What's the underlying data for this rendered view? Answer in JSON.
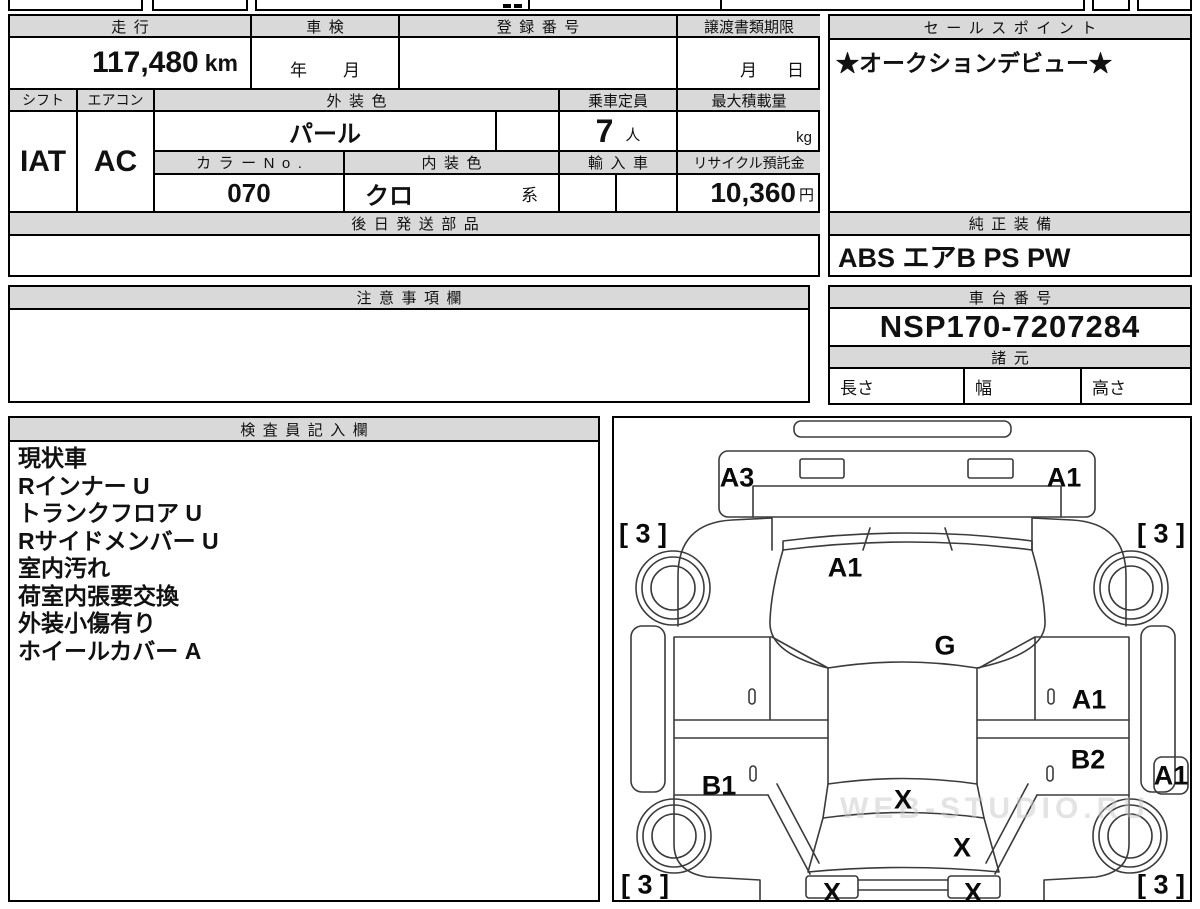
{
  "colors": {
    "header_bg": "#d9d9d9",
    "border": "#000000",
    "text": "#111111",
    "watermark_gray": "#c9c9c9"
  },
  "main_table": {
    "mileage": {
      "label": "走行",
      "value": "117,480",
      "unit": "km"
    },
    "inspection": {
      "label": "車検",
      "year": "年",
      "month": "月"
    },
    "registration": {
      "label": "登録番号",
      "value": ""
    },
    "transfer_docs": {
      "label": "譲渡書類期限",
      "month": "月",
      "day": "日"
    },
    "shift": {
      "label": "シフト",
      "value": "IAT"
    },
    "aircon": {
      "label": "エアコン",
      "value": "AC"
    },
    "exterior_color": {
      "label": "外装色",
      "value": "パール"
    },
    "capacity": {
      "label": "乗車定員",
      "value": "7",
      "unit": "人"
    },
    "max_load": {
      "label": "最大積載量",
      "value": "",
      "unit": "kg"
    },
    "color_no": {
      "label": "カラーNo.",
      "value": "070"
    },
    "interior_color": {
      "label": "内装色",
      "value": "クロ",
      "suffix": "系"
    },
    "import_car": {
      "label": "輸入車",
      "value": ""
    },
    "recycle_deposit": {
      "label": "リサイクル預託金",
      "value": "10,360",
      "unit": "円"
    },
    "later_shipped_parts": {
      "label": "後日発送部品",
      "value": ""
    }
  },
  "sales_point": {
    "label": "セールスポイント",
    "value": "★オークションデビュー★"
  },
  "genuine_equipment": {
    "label": "純正装備",
    "value": "ABS エアB PS PW"
  },
  "notes": {
    "label": "注意事項欄",
    "value": ""
  },
  "chassis_number": {
    "label": "車台番号",
    "value": "NSP170-7207284"
  },
  "specs": {
    "label": "諸元",
    "length": "長さ",
    "width": "幅",
    "height": "高さ"
  },
  "inspector": {
    "label": "検査員記入欄",
    "lines": [
      "現状車",
      "Rインナー U",
      "トランクフロア U",
      "Rサイドメンバー U",
      "室内汚れ",
      "荷室内張要交換",
      "外装小傷有り",
      "ホイールカバー A"
    ]
  },
  "diagram": {
    "watermark": "WEB-STUDIO.RU",
    "labels": [
      {
        "text": "A3",
        "x": 125,
        "y": 62
      },
      {
        "text": "A1",
        "x": 452,
        "y": 62
      },
      {
        "text": "[ 3 ]",
        "x": 31,
        "y": 118
      },
      {
        "text": "[ 3 ]",
        "x": 549,
        "y": 118
      },
      {
        "text": "A1",
        "x": 233,
        "y": 152
      },
      {
        "text": "G",
        "x": 333,
        "y": 230
      },
      {
        "text": "A1",
        "x": 477,
        "y": 284
      },
      {
        "text": "B2",
        "x": 476,
        "y": 344
      },
      {
        "text": "A1",
        "x": 559,
        "y": 360
      },
      {
        "text": "B1",
        "x": 107,
        "y": 370
      },
      {
        "text": "X",
        "x": 291,
        "y": 384
      },
      {
        "text": "X",
        "x": 350,
        "y": 432
      },
      {
        "text": "X",
        "x": 220,
        "y": 477
      },
      {
        "text": "X",
        "x": 361,
        "y": 477
      },
      {
        "text": "[ 3 ]",
        "x": 33,
        "y": 469
      },
      {
        "text": "[ 3 ]",
        "x": 549,
        "y": 469
      }
    ]
  }
}
